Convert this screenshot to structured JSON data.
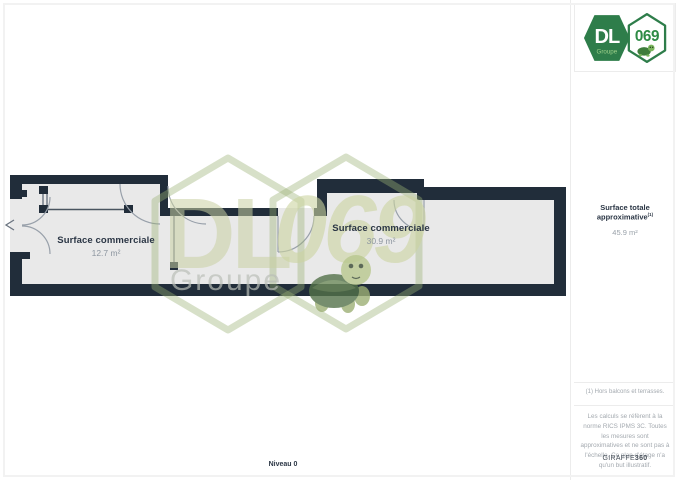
{
  "page": {
    "level_label": "Niveau 0"
  },
  "logo": {
    "dl": "DL",
    "groupe": "Groupe",
    "number": "069"
  },
  "sidebar": {
    "surface_title": "Surface totale approximative",
    "surface_sup": "(1)",
    "surface_value": "45.9 m²",
    "footnote": "(1) Hors balcons et terrasses.",
    "disclaimer": "Les calculs se réfèrent à la norme RICS IPMS 3C. Toutes les mesures sont approximatives et ne sont pas à l'échelle. Ce plan d'étage n'a qu'un but illustratif.",
    "brand": "GIRAFFE",
    "brand_suffix": "360"
  },
  "plan": {
    "rooms": [
      {
        "name": "Surface commerciale",
        "area": "12.7 m²"
      },
      {
        "name": "Surface commerciale",
        "area": "30.9 m²"
      }
    ],
    "colors": {
      "wall": "#212d3a",
      "floor": "#e9e9e9",
      "watermark_green": "#b9c68f",
      "brand_green": "#2e7d4a"
    }
  }
}
